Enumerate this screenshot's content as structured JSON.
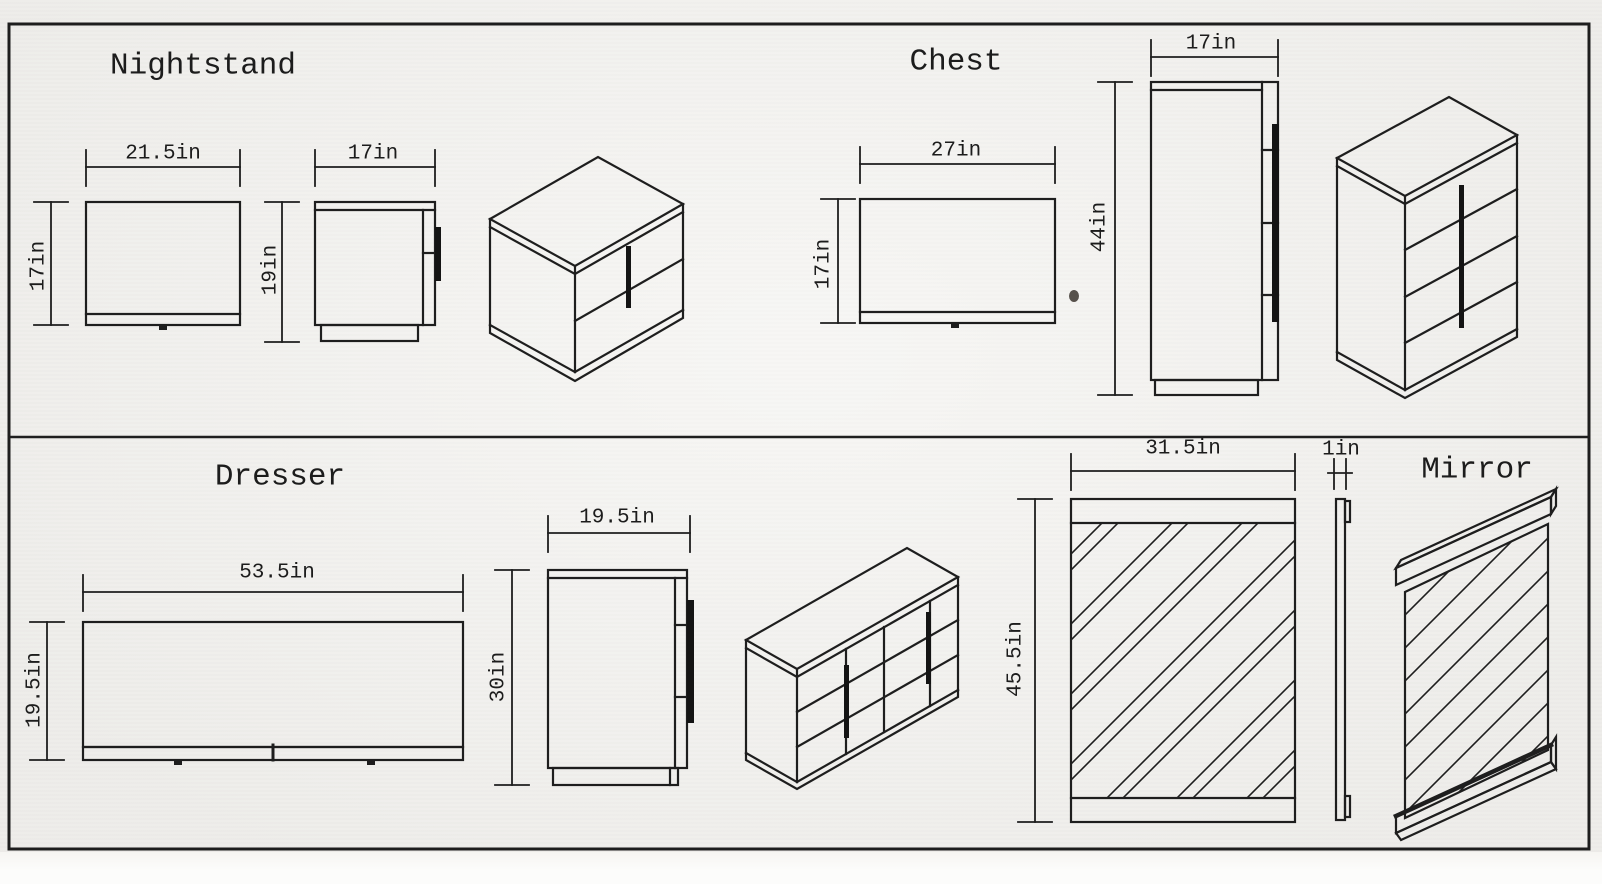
{
  "page": {
    "paper_color": "#f3f2ef",
    "line_color": "#1e1e1e",
    "unit": "in"
  },
  "sections": {
    "nightstand": {
      "title": "Nightstand",
      "front": {
        "width": "21.5in",
        "height": "17in"
      },
      "side": {
        "width": "17in",
        "height": "19in"
      }
    },
    "chest": {
      "title": "Chest",
      "front": {
        "width": "27in",
        "height": "17in"
      },
      "side": {
        "width": "17in",
        "height": "44in"
      }
    },
    "dresser": {
      "title": "Dresser",
      "front": {
        "width": "53.5in",
        "height": "19.5in"
      },
      "side": {
        "width": "19.5in",
        "height": "30in"
      }
    },
    "mirror": {
      "title": "Mirror",
      "front": {
        "width": "31.5in",
        "height": "45.5in"
      },
      "side": {
        "thickness": "1in"
      }
    }
  }
}
